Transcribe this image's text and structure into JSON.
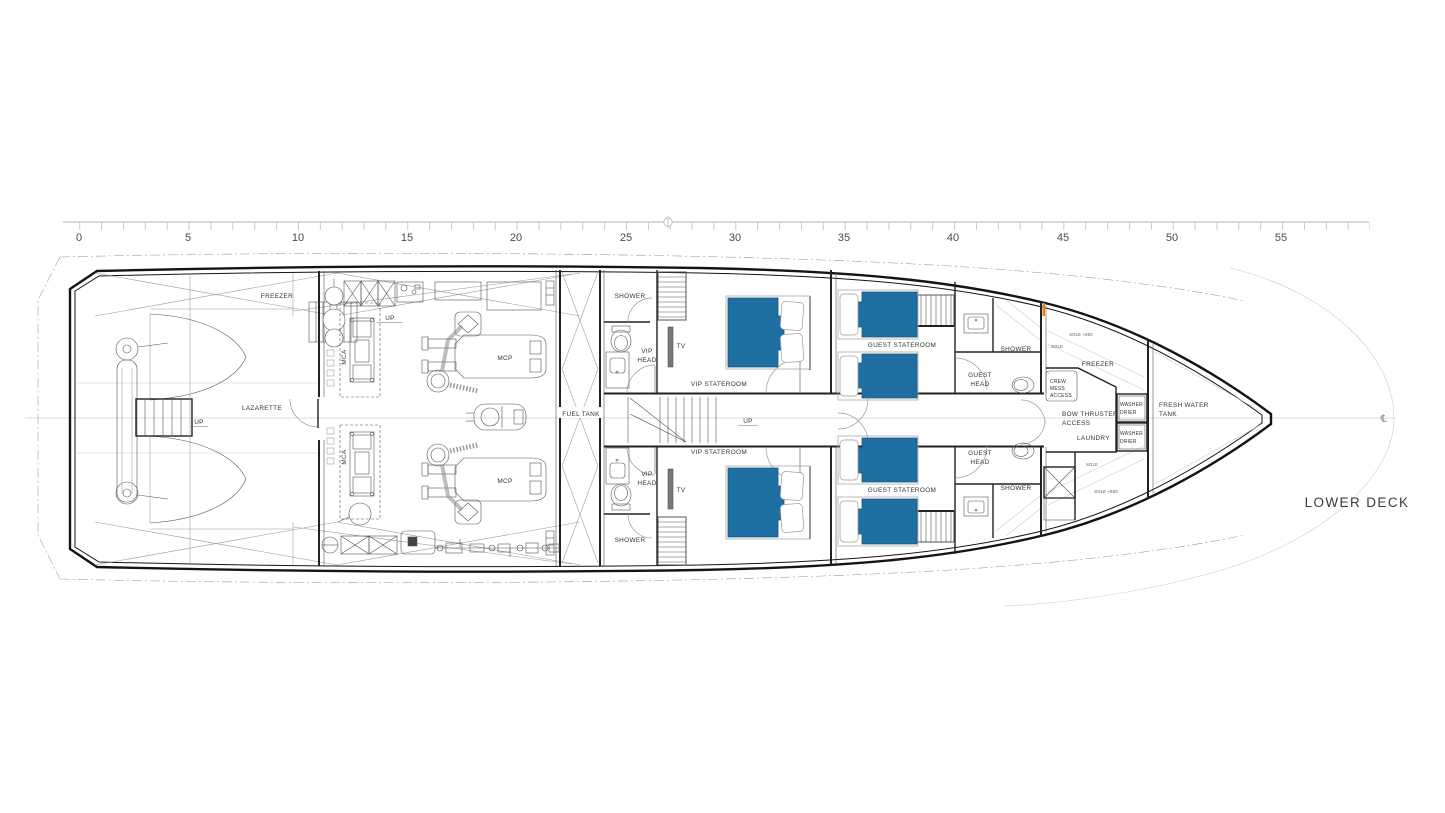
{
  "title": "LOWER DECK",
  "ruler": {
    "unit_labels": [
      "0",
      "5",
      "10",
      "15",
      "20",
      "25",
      "30",
      "35",
      "40",
      "45",
      "50",
      "55"
    ]
  },
  "labels": {
    "freezer": "FREEZER",
    "lazarette": "LAZARETTE",
    "up": "UP",
    "mca": "MCA",
    "mcp": "MCP",
    "fuel_tank": "FUEL TANK",
    "shower": "SHOWER",
    "vip_head": [
      "VIP",
      "HEAD"
    ],
    "tv": "TV",
    "vip_stateroom": "VIP STATEROOM",
    "guest_stateroom": "GUEST STATEROOM",
    "guest_head": [
      "GUEST",
      "HEAD"
    ],
    "sole_800": "SOLE +800",
    "sole": "SOLE",
    "freezer_bow": "FREEZER",
    "crew_mess": [
      "CREW",
      "MESS",
      "ACCESS"
    ],
    "bow_thruster": [
      "BOW THRUSTER",
      "ACCESS"
    ],
    "laundry": "LAUNDRY",
    "washer_drier": [
      "WASHER",
      "DRIER"
    ],
    "fresh_water": [
      "FRESH WATER",
      "TANK"
    ],
    "lower_deck": "LOWER DECK",
    "centerline_symbol": "℄"
  },
  "colors": {
    "bed": "#1F6FA3",
    "bed_stroke": "#16567F",
    "accent_orange": "#E8821E"
  }
}
